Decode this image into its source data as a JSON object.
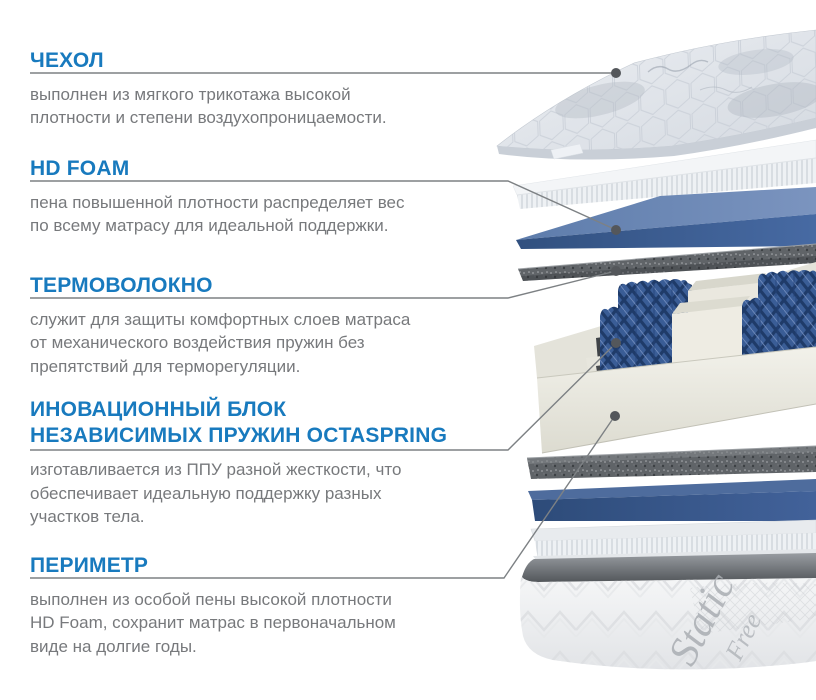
{
  "page": {
    "background": "#ffffff"
  },
  "colors": {
    "heading_blue": "#187abe",
    "body_gray": "#77797c",
    "leader_line": "#7d8184",
    "leader_dot": "#54575b",
    "foam_blue_front": "#3d5d96",
    "foam_blue_top": "#6381b0",
    "thermal_speckle": "#606468",
    "cream_foam": "#e9e8e0",
    "spring_blue": "#3a5d96"
  },
  "sections": [
    {
      "id": "cover",
      "heading": "ЧЕХОЛ",
      "body": "выполнен из мягкого трикотажа высокой\nплотности и степени воздухопроницаемости."
    },
    {
      "id": "hd-foam",
      "heading": "HD FOAM",
      "body": "пена повышенной плотности распределяет вес\nпо всему матрасу для идеальной поддержки."
    },
    {
      "id": "thermal-fiber",
      "heading": "ТЕРМОВОЛОКНО",
      "body": "служит для защиты комфортных слоев матраса\nот механического воздействия пружин без\nпрепятствий для терморегуляции."
    },
    {
      "id": "spring-block",
      "heading": "ИНОВАЦИОННЫЙ БЛОК\nНЕЗАВИСИМЫХ ПРУЖИН OCTASPRING",
      "body": "изготавливается из ППУ разной жесткости, что\nобеспечивает идеальную поддержку разных\nучастков тела."
    },
    {
      "id": "perimeter",
      "heading": "ПЕРИМЕТР",
      "body": "выполнен из особой пены высокой плотности\nHD Foam, сохранит матрас в первоначальном\nвиде на долгие годы."
    }
  ],
  "illustration": {
    "label": "exploded view of mattress layers",
    "base_fabric_word1": "Static",
    "base_fabric_word2": "Free"
  }
}
